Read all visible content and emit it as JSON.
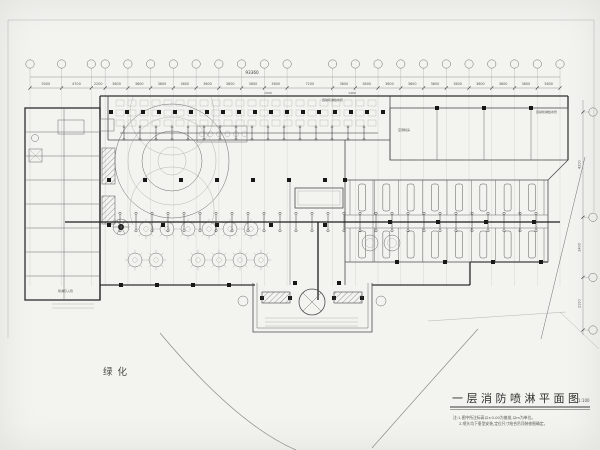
{
  "drawing": {
    "title": "一层消防喷淋平面图",
    "scale": "1:100",
    "notes": [
      "注:1.图中所注标高以±0.00为基准,以m为单位。",
      "2.喷头均下垂型安装,定位尺寸结合吊顶装修图确定。"
    ],
    "landscape_label": "绿化",
    "total_dimension": "93360",
    "sub_dimensions": [
      "1500",
      "1460"
    ],
    "top_dimensions": [
      "5000",
      "4700",
      "2200",
      "3600",
      "3600",
      "3600",
      "3600",
      "3600",
      "3600",
      "3600",
      "3600",
      "7200",
      "3600",
      "3600",
      "3600",
      "3600",
      "3600",
      "3600",
      "3600",
      "3600",
      "3600",
      "3600"
    ],
    "right_dimensions": [
      "4200",
      "2400",
      "2100"
    ],
    "room_label_ac": "空调机房",
    "pipe_label_top": "自动喷淋给水管",
    "pipe_label_right": "自动喷淋给水管",
    "pipe_label_inlet": "喷淋引入管",
    "colors": {
      "paper": "#f3f3f0",
      "ink": "#2e2e2e",
      "light_line": "#9a9a96"
    }
  }
}
